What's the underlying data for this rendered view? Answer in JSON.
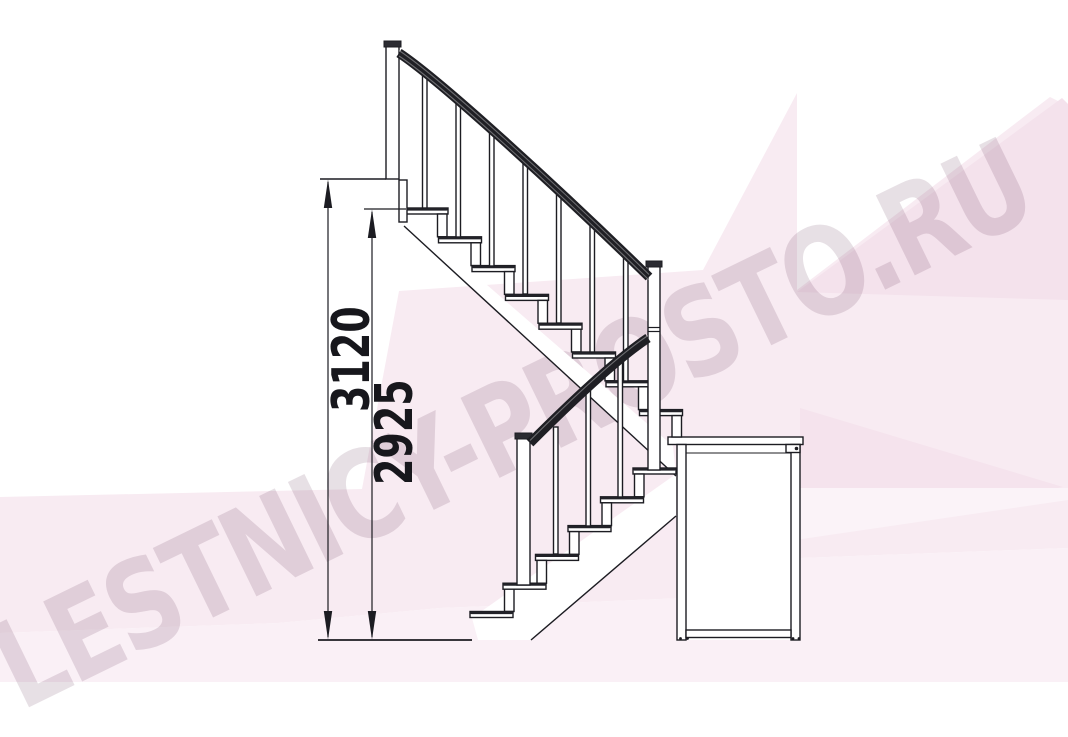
{
  "watermark": {
    "text": "LESTNICY-PROSTO.RU"
  },
  "dimensions": {
    "overall_height": {
      "label": "3120"
    },
    "secondary_height": {
      "label": "2925"
    }
  },
  "figure": {
    "type": "technical side elevation of a modular staircase with a 180-degree turn",
    "upper_flight_treads": 8,
    "lower_flight_treads": 6,
    "elements": [
      "top newel post",
      "upper handrail",
      "balusters",
      "middle newel post",
      "lower handrail",
      "bottom newel post",
      "support frame box",
      "ground line",
      "floor line"
    ]
  },
  "colors": {
    "line": "#1c1c22",
    "handrail": "#1f1f24",
    "background": "#ffffff",
    "pink_band": "#f8ebf2",
    "pink_dark": "#f4e2ec",
    "pink_light": "#faf1f6",
    "watermark": "#cfc2cb"
  }
}
